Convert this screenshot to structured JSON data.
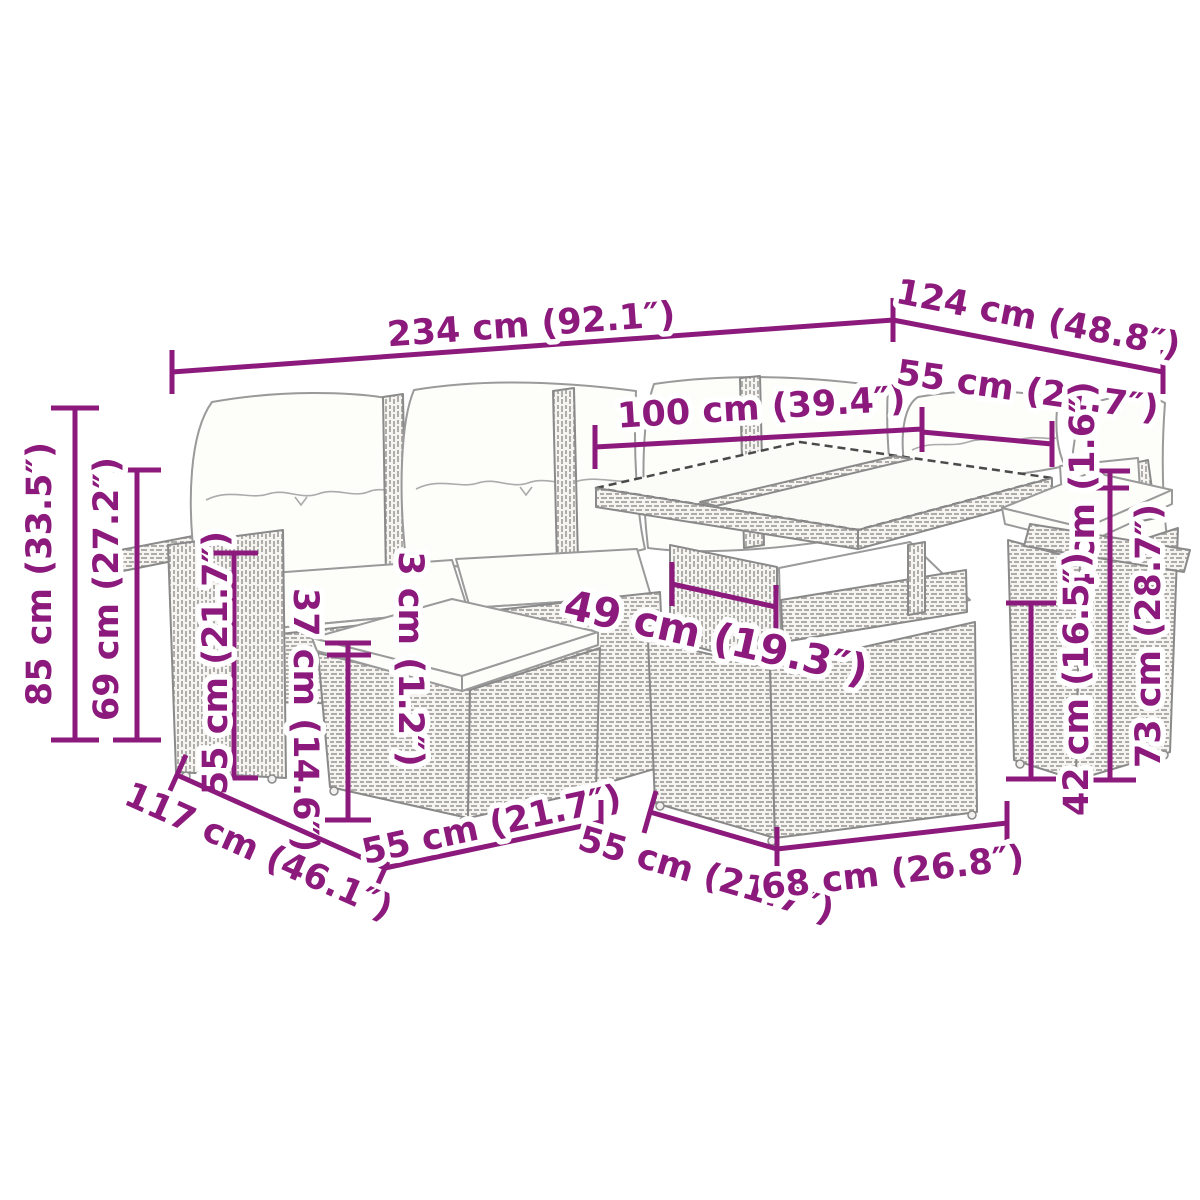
{
  "meta": {
    "accent_color": "#8C1A7C",
    "background_color": "#ffffff",
    "illustration_alt": "Line drawing of a poly rattan garden lounge set (corner sofa with cushions, footstool with cushion, storage table with glass top and end seat) annotated with dimension lines"
  },
  "diagram": {
    "unit_style": "cm (inches)",
    "dimensions": [
      {
        "id": "overall-width",
        "label": "234 cm (92.1″)"
      },
      {
        "id": "overall-depth-right",
        "label": "124 cm (48.8″)"
      },
      {
        "id": "table-width",
        "label": "100 cm (39.4″)"
      },
      {
        "id": "right-seat-width",
        "label": "55 cm (21.7″)"
      },
      {
        "id": "seat-cushion-thickness-right",
        "label": "4 cm (1.6″)"
      },
      {
        "id": "table-height",
        "label": "73 cm (28.7″)"
      },
      {
        "id": "shelf-opening-height",
        "label": "42 cm (16.5″)"
      },
      {
        "id": "overall-height",
        "label": "85 cm (33.5″)"
      },
      {
        "id": "back-height",
        "label": "69 cm (27.2″)"
      },
      {
        "id": "armrest-height",
        "label": "55 cm (21.7″)"
      },
      {
        "id": "stool-cushion-thickness",
        "label": "3 cm (1.2″)"
      },
      {
        "id": "stool-height",
        "label": "37 cm (14.6″)"
      },
      {
        "id": "table-support-width",
        "label": "49 cm (19.3″)"
      },
      {
        "id": "overall-depth-left",
        "label": "117 cm (46.1″)"
      },
      {
        "id": "stool-width",
        "label": "55 cm (21.7″)"
      },
      {
        "id": "seat-depth",
        "label": "55 cm (21.7″)"
      },
      {
        "id": "table-depth",
        "label": "68 cm (26.8″)"
      }
    ]
  }
}
